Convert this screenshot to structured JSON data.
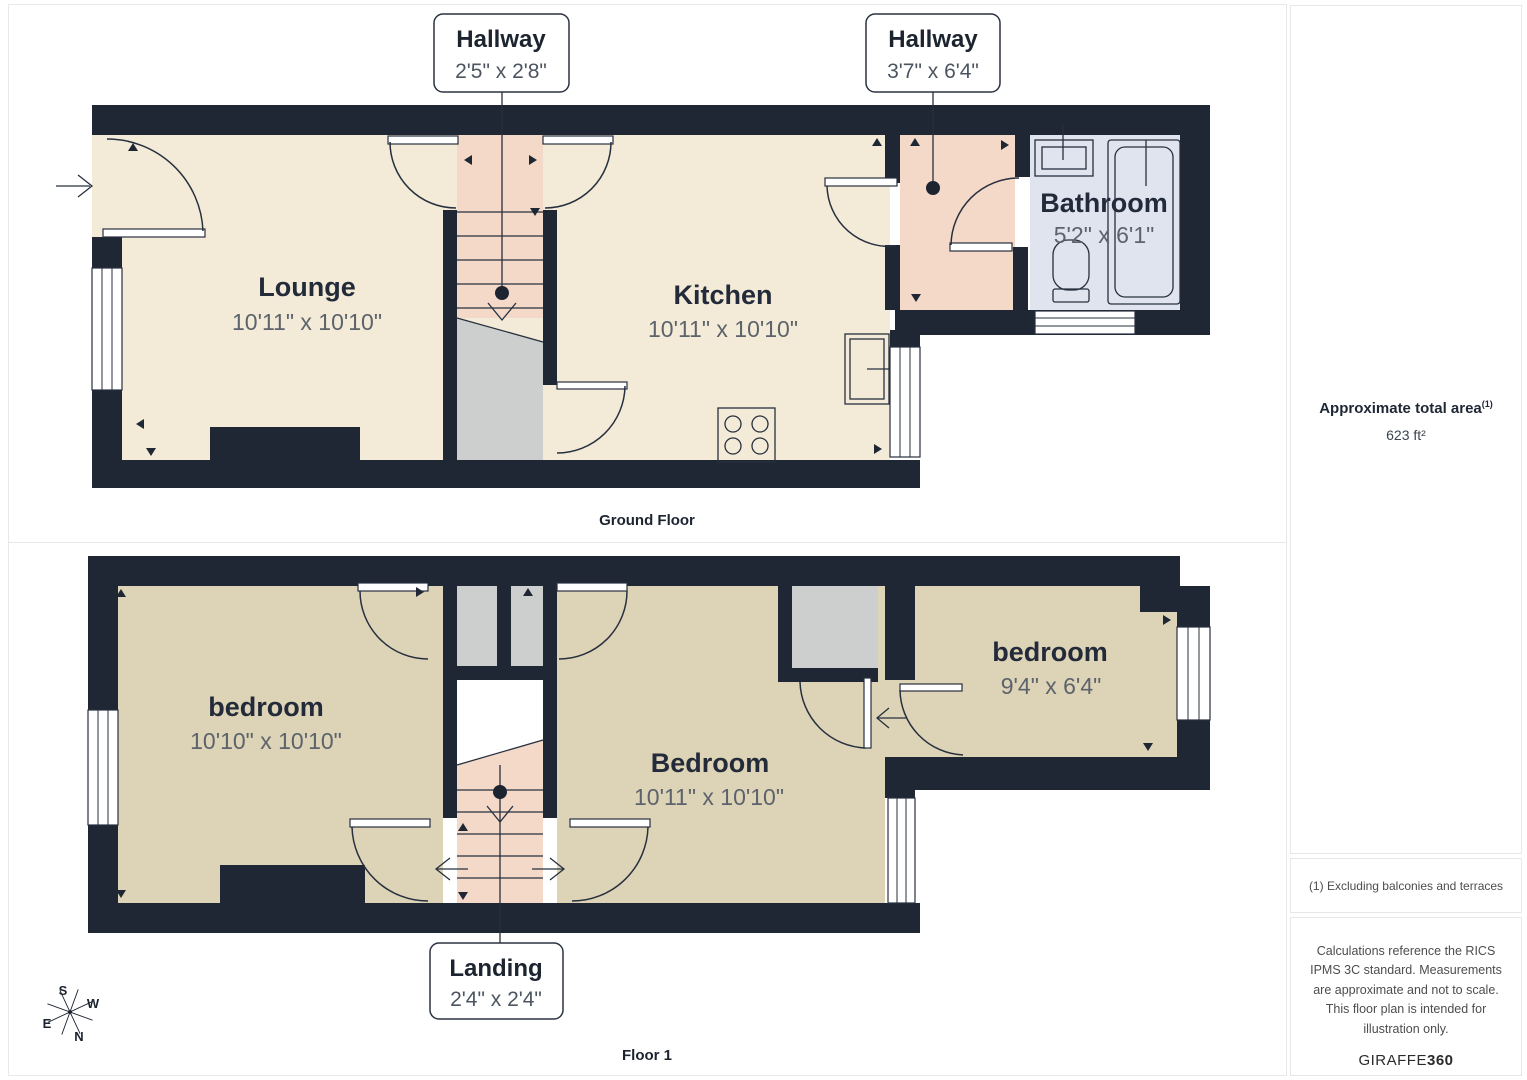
{
  "ground_floor": {
    "caption": "Ground Floor",
    "rooms": [
      {
        "name": "Lounge",
        "dims": "10'11\" x 10'10\""
      },
      {
        "name": "Kitchen",
        "dims": "10'11\" x 10'10\""
      },
      {
        "name": "Bathroom",
        "dims": "5'2\" x 6'1\""
      }
    ],
    "callouts": [
      {
        "name": "Hallway",
        "dims": "2'5\" x 2'8\""
      },
      {
        "name": "Hallway",
        "dims": "3'7\" x 6'4\""
      }
    ]
  },
  "floor_1": {
    "caption": "Floor 1",
    "rooms": [
      {
        "name": "bedroom",
        "dims": "10'10\" x 10'10\""
      },
      {
        "name": "Bedroom",
        "dims": "10'11\" x 10'10\""
      },
      {
        "name": "bedroom",
        "dims": "9'4\" x 6'4\""
      }
    ],
    "callouts": [
      {
        "name": "Landing",
        "dims": "2'4\" x 2'4\""
      }
    ]
  },
  "sidebar": {
    "area_title": "Approximate total area",
    "area_title_sup": "(1)",
    "area_value": "623 ft²",
    "footnote": "(1) Excluding balconies and terraces",
    "disclaimer": "Calculations reference the RICS IPMS 3C standard. Measurements are approximate and not to scale. This floor plan is intended for illustration only.",
    "brand_name": "GIRAFFE",
    "brand_suffix": "360"
  },
  "compass": {
    "top": "S",
    "right": "W",
    "left": "E",
    "bottom": "N"
  },
  "colors": {
    "wall": "#1f2734",
    "cream": "#f3ebd7",
    "tan": "#ddd3b6",
    "pink": "#f4d8c8",
    "gray": "#cdcfce",
    "bath_blue": "#dfe4ef",
    "label": "#232b3a",
    "dims": "#5d636c"
  }
}
